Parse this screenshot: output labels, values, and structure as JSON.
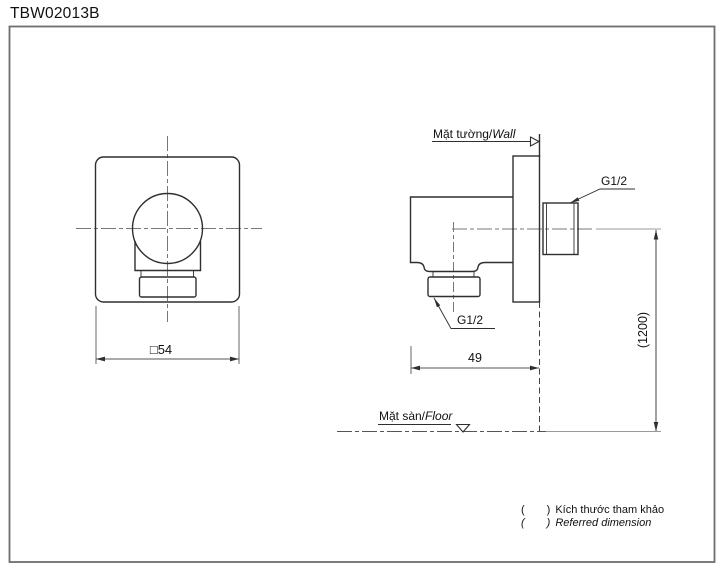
{
  "title": "TBW02013B",
  "colors": {
    "line": "#2f2f2f",
    "center": "#777777",
    "dim": "#555555",
    "frame": "#6e6e6e",
    "aux": "#9a9a9a"
  },
  "front_view": {
    "dim_width": "□54"
  },
  "side_view": {
    "wall_label_vi": "Mặt tường/",
    "wall_label_en": "Wall",
    "floor_label_vi": "Mặt sàn/",
    "floor_label_en": "Floor",
    "thread_top": "G1/2",
    "thread_bottom": "G1/2",
    "dim_depth": "49",
    "dim_height": "(1200)"
  },
  "legend": {
    "line1": {
      "open": "(",
      "close": ")",
      "text": "Kích thước tham khảo"
    },
    "line2": {
      "open": "(",
      "close": ")",
      "text": "Referred dimension"
    }
  }
}
